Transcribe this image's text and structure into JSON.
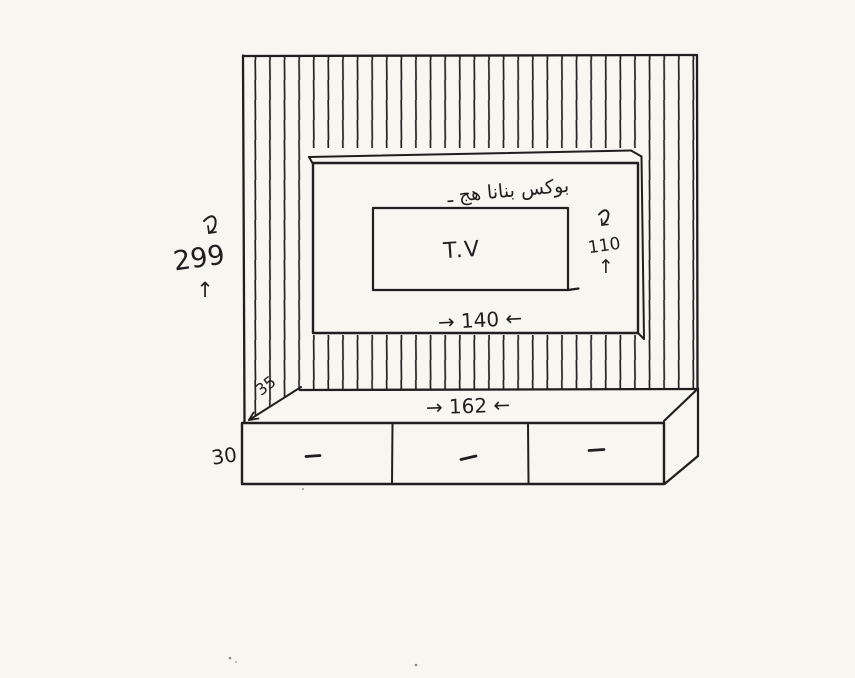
{
  "drawing": {
    "title": "Hand-drawn TV wall unit sketch",
    "colors": {
      "ink": "#1f1f1f",
      "paper": "#f8f6f1"
    },
    "wall_panel": {
      "height_label": "299",
      "up_arrow": "↑"
    },
    "tv_box": {
      "note_arabic": "بوكس بنانا هج ـ",
      "tv_label": "T.V",
      "width_label": "→ 140 ←",
      "height_label": "110",
      "up_arrow": "↑"
    },
    "cabinet": {
      "width_label": "→ 162 ←",
      "height_label": "30",
      "depth_label": "35"
    }
  }
}
